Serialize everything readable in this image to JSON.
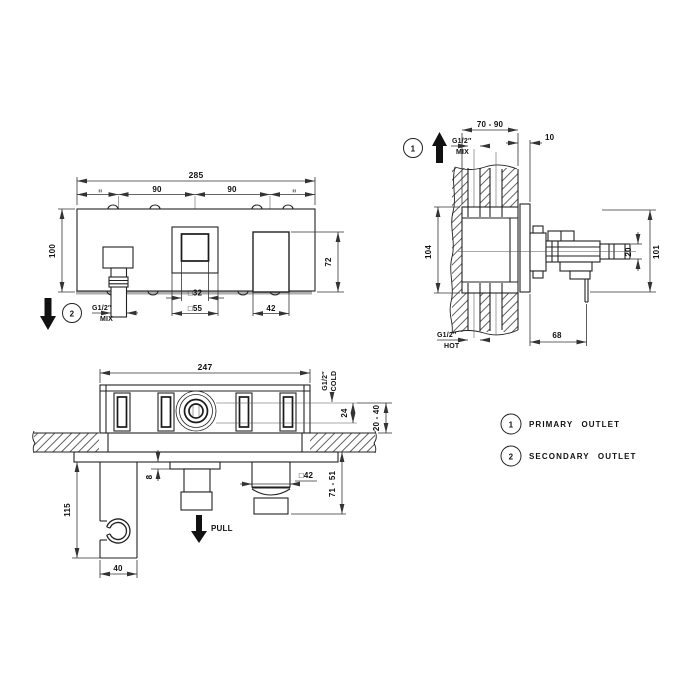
{
  "front_view": {
    "overall_width": "285",
    "spacing_left": "90",
    "spacing_right": "90",
    "equal_mark": "=",
    "plate_height": "100",
    "handle_height": "72",
    "inner_square": "□32",
    "outer_square": "□55",
    "handle_width": "42",
    "outlet_num": "2",
    "thread": "G1/2″",
    "thread_type": "MIX"
  },
  "side_view": {
    "outlet_num": "1",
    "thread_top": "G1/2″",
    "thread_top_type": "MIX",
    "depth_range": "70 - 90",
    "plate_offset": "10",
    "box_height": "104",
    "knob_height": "20",
    "total_height": "101",
    "protrusion": "68",
    "thread_bottom": "G1/2″",
    "thread_bottom_type": "HOT"
  },
  "bottom_view": {
    "box_width": "247",
    "thread_right": "G1/2″",
    "thread_right_type": "COLD",
    "port_offset": "24",
    "depth_range": "20 - 40",
    "flange_thickness": "8",
    "pull_label": "PULL",
    "handle_square": "□42",
    "handle_protrusion": "71 - 51",
    "holder_height": "115",
    "holder_width": "40"
  },
  "legend": {
    "items": [
      {
        "num": "1",
        "label": "PRIMARY OUTLET"
      },
      {
        "num": "2",
        "label": "SECONDARY OUTLET"
      }
    ]
  }
}
